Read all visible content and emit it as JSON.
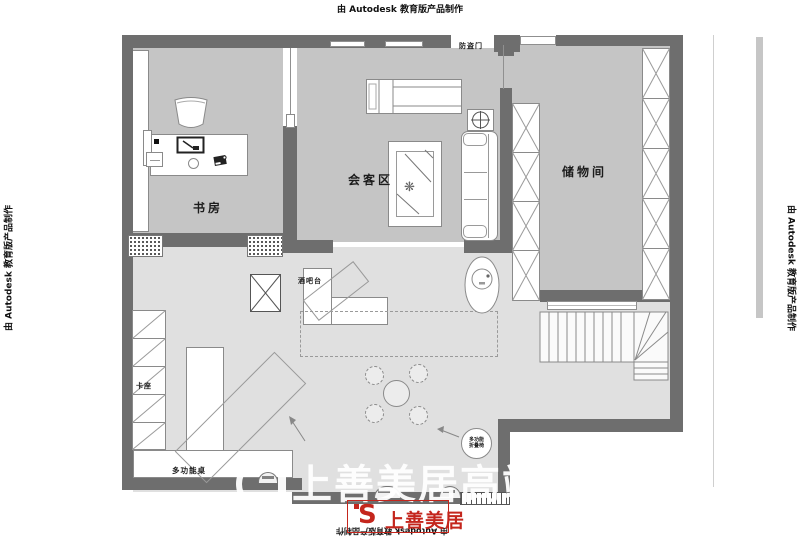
{
  "credits": {
    "autodesk": "由 Autodesk 教育版产品制作"
  },
  "rooms": {
    "study": "书房",
    "reception": "会客区",
    "storage": "储物间"
  },
  "labels": {
    "security_door": "防盗门",
    "bar_counter": "酒吧台",
    "booth": "卡座",
    "multi_table": "多功能桌",
    "folding_chair_l1": "多功能",
    "folding_chair_l2": "折叠椅"
  },
  "watermark": {
    "text": "上善美居高端整装",
    "logo_mark": "S",
    "logo_name": "上善美居"
  },
  "colors": {
    "wall": "#6e6e6e",
    "room_floor": "#c5c5c5",
    "open_floor": "#e0e0e0",
    "furniture_line": "#8a8a8a",
    "logo_red": "#c4261d",
    "watermark_white": "#ffffff"
  }
}
